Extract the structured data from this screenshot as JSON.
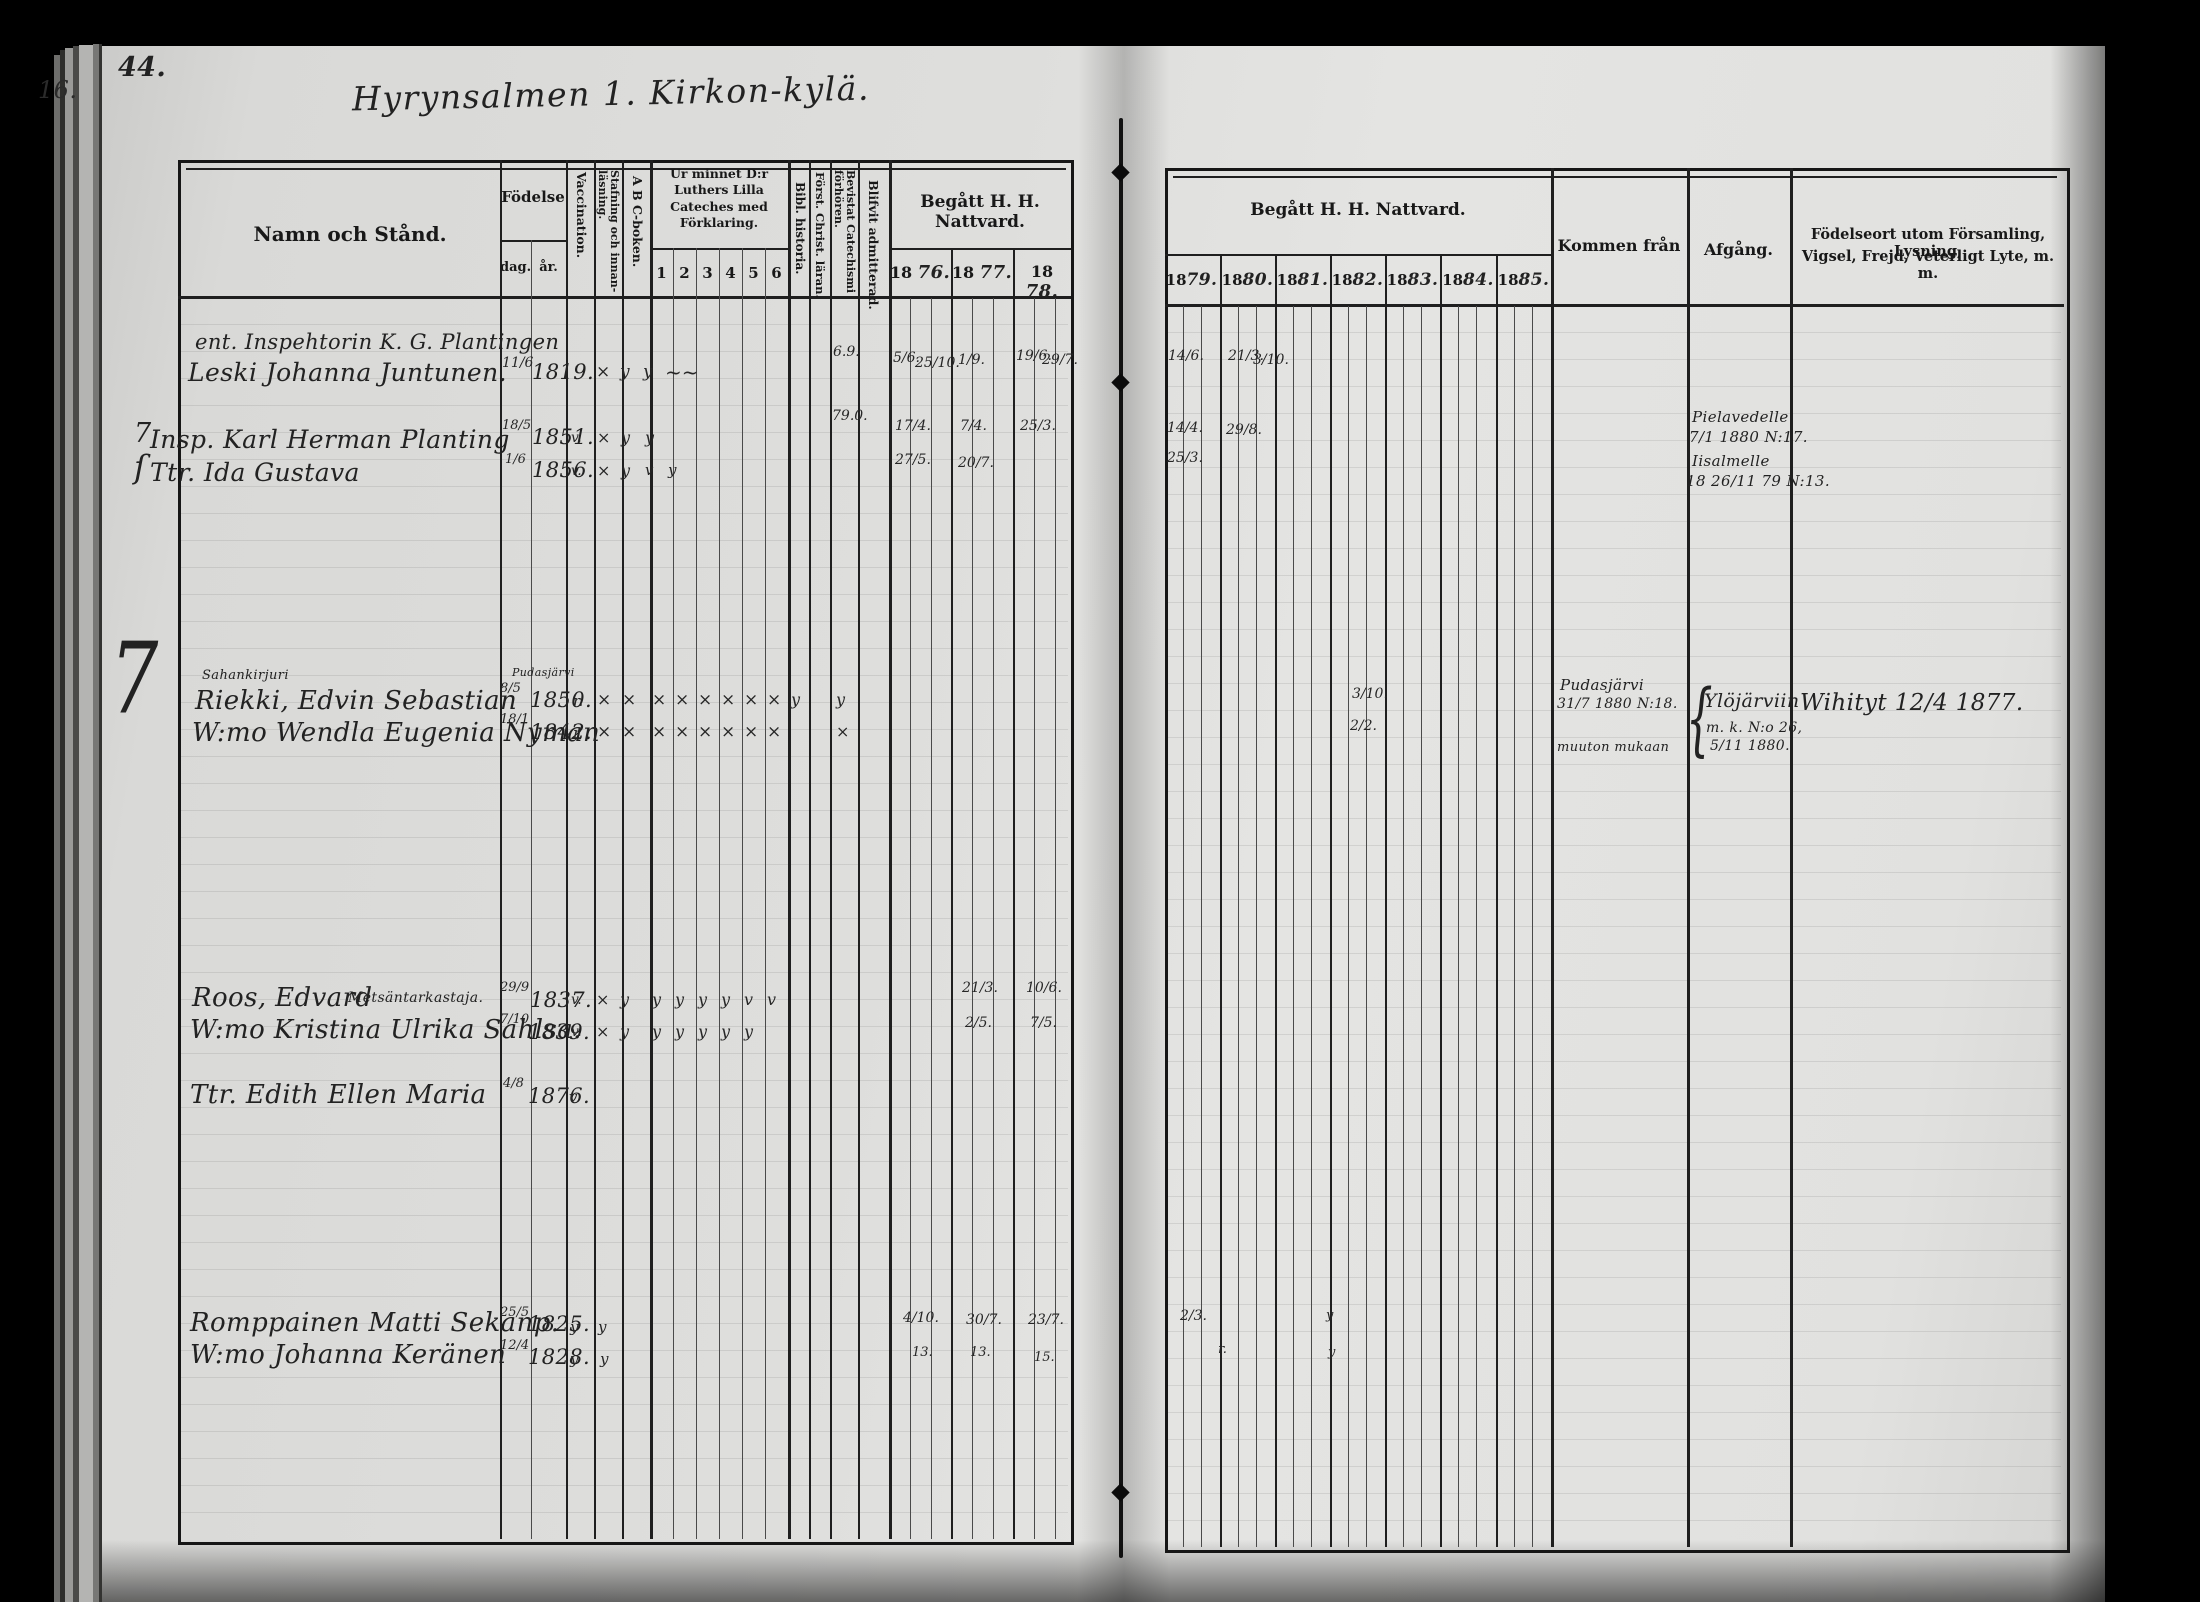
{
  "page": {
    "number": "44.",
    "edge_number": "16.",
    "title": "Hyrynsalmen 1. Kirkon-kylä."
  },
  "left_header": {
    "name": "Namn och Stånd.",
    "birth": "Födelse",
    "day": "dag.",
    "year": "år.",
    "vaccination": "Vaccination.",
    "spelling": "Stafning och innan-läsning.",
    "abc": "A B C-boken.",
    "catechism": "Ur minnet D:r Luthers Lilla Cateches med Förklaring.",
    "c1": "1",
    "c2": "2",
    "c3": "3",
    "c4": "4",
    "c5": "5",
    "c6": "6",
    "bible": "Bibl. historia.",
    "christian": "Först. Christ. läran.",
    "attended": "Bevistat Catechismi förhören.",
    "admitted": "Blifvit admitterad.",
    "communion": "Begått H. H. Nattvard.",
    "pre": "18",
    "y1876": "76.",
    "y1877": "77.",
    "y1878": "78."
  },
  "right_header": {
    "communion": "Begått H. H. Nattvard.",
    "pre": "18",
    "y1879": "79.",
    "y1880": "80.",
    "y1881": "81.",
    "y1882": "82.",
    "y1883": "83.",
    "y1884": "84.",
    "y1885": "85.",
    "come_from": "Kommen från",
    "departure": "Afgång.",
    "birthplace1": "Födelseort utom Församling, Lysning,",
    "birthplace2": "Vigsel, Frejd, Veterligt Lyte, m. m."
  },
  "margin": {
    "big_seven": "7"
  },
  "rows": {
    "juntunen": {
      "note": "ent. Inspehtorin K. G. Plantingen",
      "name": "Leski Johanna Juntunen.",
      "day": "11/6",
      "year": "1819.",
      "staf": "×",
      "abc": "y",
      "c1": "y",
      "scribble": "~~",
      "attended": "6.9.",
      "m76a": "5/6.",
      "m76b": "25/10.",
      "m77": "1/9.",
      "m78a": "19/6.",
      "m78b": "29/7.",
      "m79": "14/6.",
      "m80a": "21/3.",
      "m80b": "3/10."
    },
    "planting": {
      "margin": "7",
      "name": "Insp. Karl Herman Planting",
      "day": "18/5",
      "year": "1851.",
      "vacc": "v.",
      "staf": "×",
      "abc": "y",
      "c1": "y",
      "attended": "79.0.",
      "m76": "17/4.",
      "m77": "7/4.",
      "m78": "25/3.",
      "m79": "14/4.",
      "m80": "29/8.",
      "dep1": "Pielavedelle",
      "dep2": "7/1 1880 N:17."
    },
    "ida": {
      "bracket": "ſ",
      "name": "Ttr. Ida Gustava",
      "day": "1/6",
      "year": "1856.",
      "vacc": "v.",
      "staf": "×",
      "abc": "y",
      "c1": "v",
      "c2": "y",
      "m76": "27/5.",
      "m77": "20/7.",
      "m79": "25/3.",
      "dep1": "Iisalmelle",
      "dep2": "18 26/11 79 N:13."
    },
    "riekki": {
      "occ": "Sahankirjuri",
      "name": "Riekki, Edvin Sebastian",
      "born_note": "Pudasjärvi",
      "day": "8/5",
      "year": "1850.",
      "vacc": "r.",
      "staf": "×",
      "abc": "×",
      "c1": "×",
      "c2": "×",
      "c3": "×",
      "c4": "×",
      "c5": "×",
      "c6": "×",
      "bible": "y",
      "attended": "y",
      "m80": "3/10.",
      "from1": "Pudasjärvi",
      "from2": "31/7 1880 N:18.",
      "from3": "muuton mukaan",
      "brace": "{",
      "dep1": "Ylöjärviin",
      "dep2": "m. k. N:o 26,",
      "dep3": "5/11 1880.",
      "note": "Wihityt 12/4 1877."
    },
    "nyman": {
      "name": "W:mo Wendla Eugenia Nyman",
      "day": "18/1",
      "year": "1842.",
      "vacc": "r.",
      "staf": "×",
      "abc": "×",
      "c1": "×",
      "c2": "×",
      "c3": "×",
      "c4": "×",
      "c5": "×",
      "c6": "×",
      "attended": "×",
      "m80": "2/2."
    },
    "roos": {
      "name": "Roos, Edvard",
      "occ": "Metsäntarkastaja.",
      "day": "29/9",
      "year": "1837.",
      "vacc": "v.",
      "staf": "×",
      "abc": "y",
      "c1": "y",
      "c2": "y",
      "c3": "y",
      "c4": "y",
      "c5": "v",
      "c6": "v",
      "m77": "21/3.",
      "m78": "10/6."
    },
    "sahlsa": {
      "name": "W:mo Kristina Ulrika Sahlsa.",
      "day": "7/10",
      "year": "1839.",
      "vacc": "v.",
      "staf": "×",
      "abc": "y",
      "c1": "y",
      "c2": "y",
      "c3": "y",
      "c4": "y",
      "c5": "y",
      "m77": "2/5.",
      "m78": "7/5."
    },
    "edith": {
      "name": "Ttr. Edith Ellen Maria",
      "day": "4/8",
      "year": "1876.",
      "vacc": "v"
    },
    "romppainen": {
      "name": "Romppainen Matti Sekanp.",
      "day": "25/5",
      "year": "1825.",
      "vacc": "y",
      "staf": "y",
      "m76": "4/10.",
      "m77": "30/7.",
      "m78": "23/7.",
      "m79": "2/3.",
      "m82": "y"
    },
    "keranen": {
      "name": "W:mo Johanna Keränen",
      "day": "12/4",
      "year": "1828.",
      "vacc": "y",
      "staf": "y",
      "m76": "13.",
      "m77": "13.",
      "m78": "15.",
      "m79": "r.",
      "m82": "y"
    }
  }
}
